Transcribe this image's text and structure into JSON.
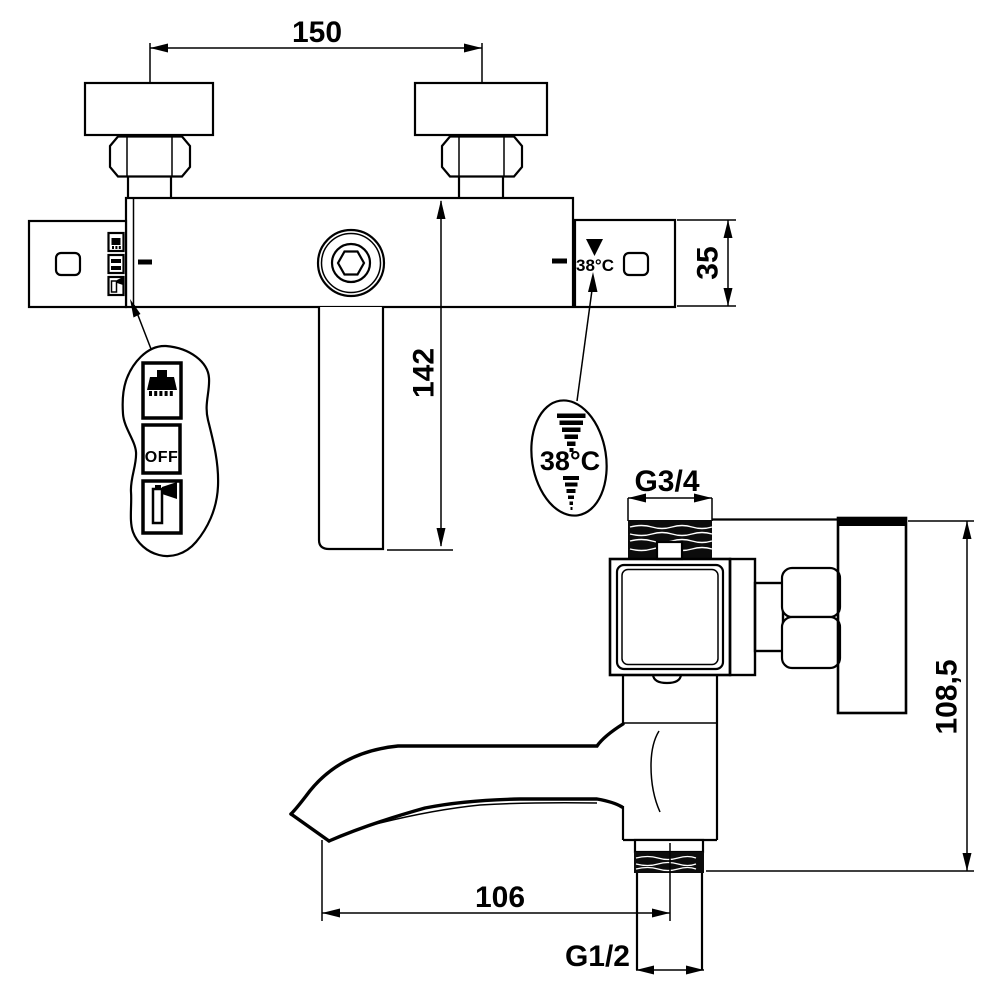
{
  "page": {
    "background": "#ffffff",
    "line_color": "#000000",
    "drawing_type": "thermostatic bath mixer installation drawing"
  },
  "front_view": {
    "dim_mounting_spacing": "150",
    "dim_drop": "142",
    "dim_body_height": "35",
    "temperature_marking": "38°C",
    "buttons_callout": {
      "shower_icon": "handshower-icon",
      "off_label": "OFF",
      "spout_icon": "bath-spout-icon"
    },
    "temperature_callout": {
      "label": "38°C",
      "big_triangle_icon": "temperature-scale-icon",
      "small_triangle_icon": "temperature-scale-small-icon"
    }
  },
  "side_view": {
    "dim_inlet_thread": "G3/4",
    "dim_total_height": "108,5",
    "dim_spout_reach": "106",
    "dim_outlet_thread": "G1/2"
  }
}
